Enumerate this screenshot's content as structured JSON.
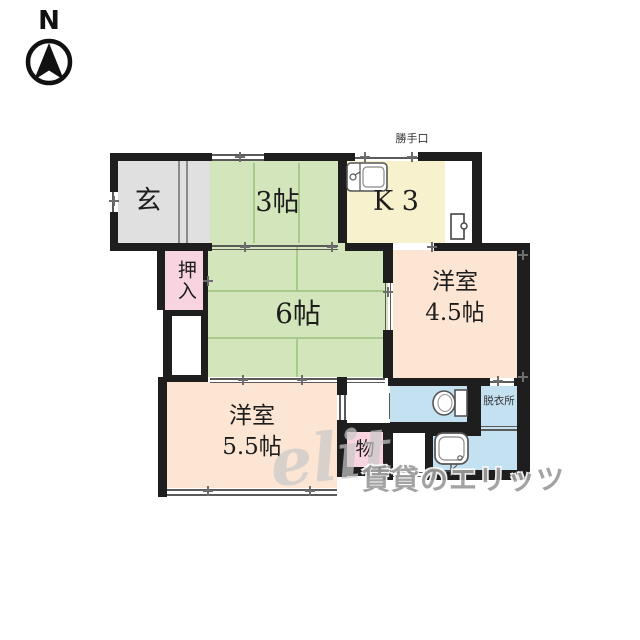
{
  "compass": {
    "label": "N"
  },
  "labels": {
    "katteguchi": "勝手口",
    "genkan": "玄",
    "tatami3": "3帖",
    "kitchen": "K 3",
    "oshiire": "押入",
    "tatami6": "6帖",
    "western45_name": "洋室",
    "western45_size": "4.5帖",
    "western55_name": "洋室",
    "western55_size": "5.5帖",
    "storage": "物",
    "dressing": "脱衣所"
  },
  "watermark": {
    "script": "elit",
    "brand": "賃貸のエリッツ"
  },
  "icons": [
    "north-arrow-icon",
    "kitchen-sink-icon",
    "water-heater-icon",
    "toilet-icon",
    "bathtub-icon"
  ],
  "colors": {
    "wall": "#1e1e1e",
    "tatami_room": "#d3e5ba",
    "kitchen_room": "#f8f1cd",
    "western_room": "#fce5d3",
    "closet_pink": "#f8d4e0",
    "wet_area_blue": "#c4e1f2",
    "entrance_gray": "#e0e0e0"
  }
}
